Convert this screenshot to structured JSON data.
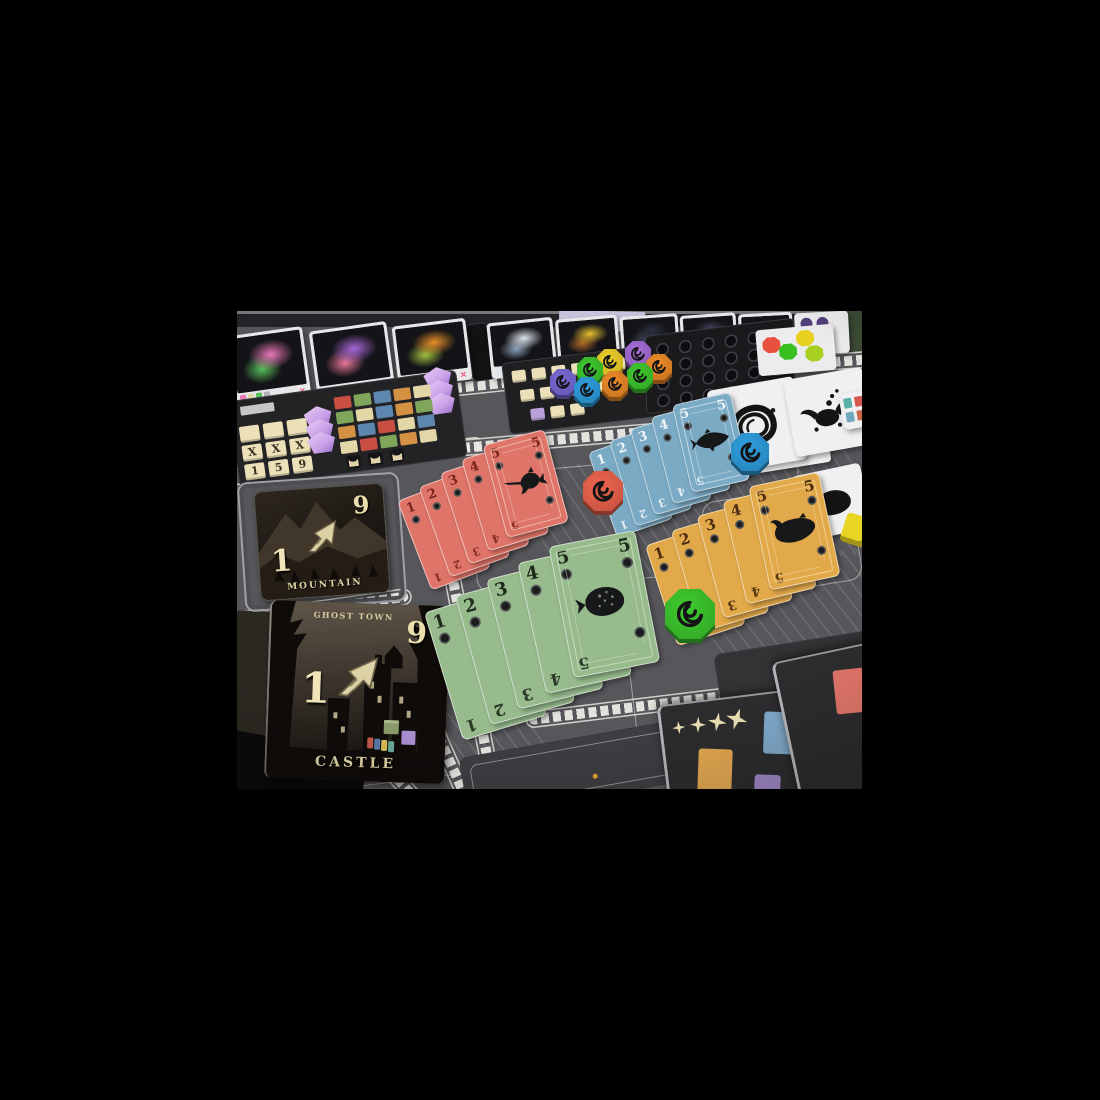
{
  "meta": {
    "description": "Photograph of a dark gothic board game mid-play on a table"
  },
  "board": {
    "surface_color": "#57575b",
    "panel_color": "#232326",
    "track_color": "#eceae4"
  },
  "market_row": {
    "reject_mark": "✕",
    "cards": [
      {
        "name": "moth-creature",
        "colors": [
          "#e878b8",
          "#58c05a"
        ]
      },
      {
        "name": "winged-spirit",
        "colors": [
          "#a868d8",
          "#e87898"
        ]
      },
      {
        "name": "kraken",
        "colors": [
          "#e89028",
          "#a0c040"
        ]
      },
      {
        "name": "unicorn",
        "colors": [
          "#dfe6ee",
          "#8aa0b8"
        ]
      },
      {
        "name": "moon-beast",
        "colors": [
          "#e8c030",
          "#b06828"
        ]
      },
      {
        "name": "night-card",
        "colors": [
          "#2c3240",
          "#3a4254"
        ]
      },
      {
        "name": "relic-card",
        "colors": [
          "#4a3e5e",
          "#6a5a86"
        ]
      },
      {
        "name": "night-card",
        "colors": [
          "#26282e",
          "#34363c"
        ]
      },
      {
        "name": "coin-card",
        "colors": [
          "#53407a",
          "#3c3050"
        ]
      }
    ]
  },
  "player_board": {
    "tile_rows": [
      [
        "",
        "",
        ""
      ],
      [
        "X",
        "X",
        "X"
      ],
      [
        "1",
        "5",
        "9"
      ]
    ],
    "grid_colors": [
      "#c94f43",
      "#7fa65a",
      "#5e87b0",
      "#d49043",
      "#e3d7a8",
      "#7fa65a",
      "#e3d7a8",
      "#5e87b0",
      "#d49043",
      "#7fa65a",
      "#d49043",
      "#5e87b0",
      "#c94f43",
      "#e3d7a8",
      "#5e87b0",
      "#e3d7a8",
      "#c94f43",
      "#7fa65a",
      "#d49043",
      "#e3d7a8"
    ],
    "gem_color": "#c9a0e8"
  },
  "middle_panel": {
    "row1": [
      "#ece0b8",
      "#ece0b8",
      "#ece0b8",
      "#ece0b8",
      "#ece0b8",
      "#ece0b8"
    ],
    "row2": [
      "#ece0b8",
      "#ece0b8",
      "#b9a0d8",
      "#b9a0d8",
      "#ece0b8"
    ],
    "row3": [
      "#b9a0d8",
      "#ece0b8",
      "#ece0b8"
    ]
  },
  "dice_panel": {
    "rows": 4,
    "cols": 6
  },
  "hex_tokens": [
    "#e85040",
    "#e8d020",
    "#38c020",
    "#a8d020"
  ],
  "coin_circles": [
    "#53407a",
    "#53407a",
    "#53407a",
    "#53407a"
  ],
  "token_cluster": [
    "#a66fd8",
    "#f08c28",
    "#3fca2f",
    "#f0d22a",
    "#3fca2f",
    "#7a6ad8",
    "#2f9fe0",
    "#f08c28"
  ],
  "loose_tokens": [
    {
      "name": "red-swirl-token",
      "color": "#f0654f"
    },
    {
      "name": "blue-swirl-token",
      "color": "#2f9fe0"
    },
    {
      "name": "green-swirl-token",
      "color": "#3ecb2e"
    },
    {
      "name": "yellow-die",
      "color": "#e8d422"
    }
  ],
  "ink_cards": {
    "multiplier": "10✕",
    "strip_colors": [
      "#e89050",
      "#d85850",
      "#58b0a8",
      "#e0d0a0",
      "#c86848",
      "#70a8c0",
      "#e8b060",
      "#b05048"
    ]
  },
  "locations": {
    "mountain": {
      "title": "MOUNTAIN",
      "min": "1",
      "max": "9"
    },
    "castle": {
      "title": "CASTLE",
      "region": "GHOST TOWN",
      "min": "1",
      "max": "9"
    },
    "edge_value": "2"
  },
  "card_fans": {
    "numbers": [
      "1",
      "2",
      "3",
      "4",
      "5"
    ],
    "corner_value": "5",
    "fish_color": "#17181a",
    "sets": [
      {
        "id": "red",
        "fish": "swordfish",
        "card_color": "#df7468",
        "number_color": "#7a241c",
        "line_color": "#f2c9bc"
      },
      {
        "id": "blue",
        "fish": "salmon",
        "card_color": "#7baac4",
        "number_color": "#eef4f8",
        "line_color": "#d4e4ee"
      },
      {
        "id": "green",
        "fish": "pufferfish",
        "card_color": "#97bb8d",
        "number_color": "#1e2a1a",
        "line_color": "#cfe2c4"
      },
      {
        "id": "yellow",
        "fish": "carp",
        "card_color": "#e2a94a",
        "number_color": "#4a2c10",
        "line_color": "#f4dba4"
      }
    ]
  },
  "score_board": {
    "stars": 4,
    "star_color": "#eadfb2",
    "slot_colors": [
      "#e0a650",
      "#7fa8c8",
      "#8fb483",
      "#9c85c2"
    ],
    "side_slot_color": "#df7468"
  }
}
